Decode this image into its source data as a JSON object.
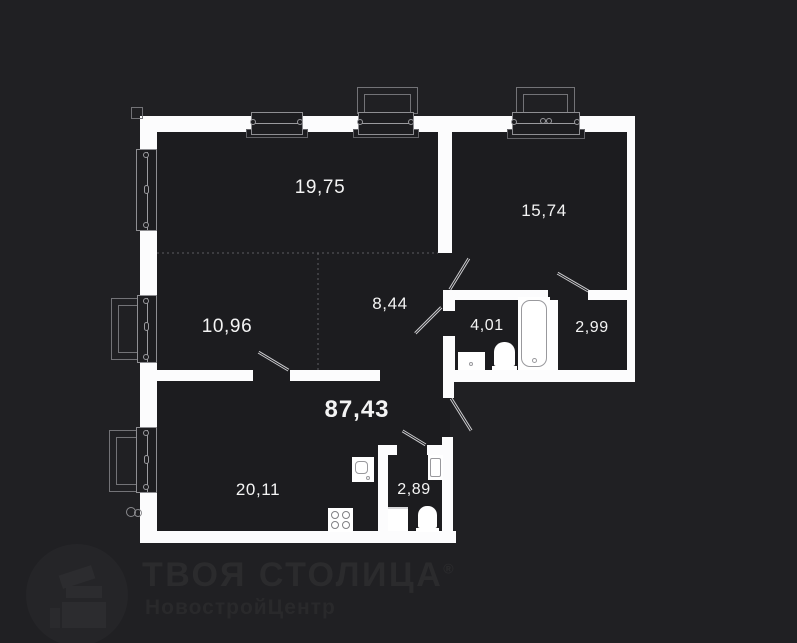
{
  "plan": {
    "total_area": "87,43",
    "rooms": [
      {
        "name": "living-room",
        "area": "19,75"
      },
      {
        "name": "bedroom",
        "area": "15,74"
      },
      {
        "name": "room",
        "area": "10,96"
      },
      {
        "name": "hallway",
        "area": "8,44"
      },
      {
        "name": "bathroom",
        "area": "4,01"
      },
      {
        "name": "wardrobe",
        "area": "2,99"
      },
      {
        "name": "kitchen-living",
        "area": "20,11"
      },
      {
        "name": "wc",
        "area": "2,89"
      }
    ]
  },
  "watermark": {
    "title": "ТВОЯ СТОЛИЦА",
    "registered": "®",
    "subtitle": "НовостройЦентр"
  },
  "colors": {
    "background": "#202023",
    "room_fill": "#1c1c1f",
    "wall": "#fcfcfd",
    "label_text": "#f4f4f4",
    "watermark_text": "#2b2b2d"
  }
}
